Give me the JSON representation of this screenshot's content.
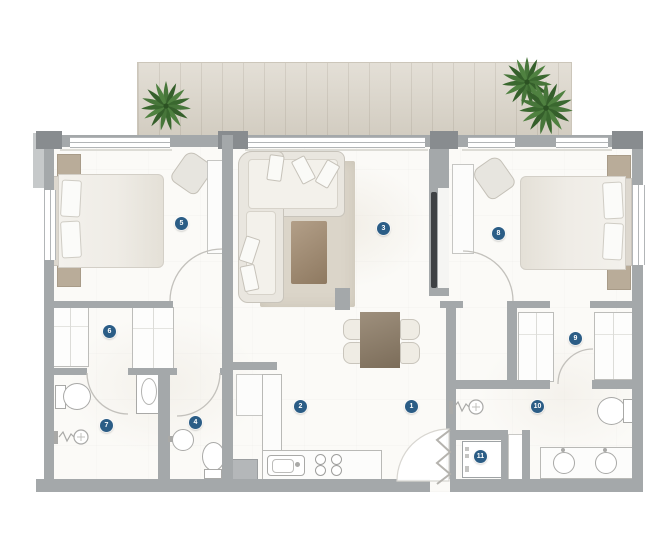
{
  "title": "apartment-floor-plan",
  "markers": [
    {
      "number": "1"
    },
    {
      "number": "2"
    },
    {
      "number": "3"
    },
    {
      "number": "4"
    },
    {
      "number": "5"
    },
    {
      "number": "6"
    },
    {
      "number": "7"
    },
    {
      "number": "8"
    },
    {
      "number": "9"
    },
    {
      "number": "10"
    },
    {
      "number": "11"
    }
  ],
  "icons": {
    "marker": "numbered-circle-badge",
    "plant": "potted-palm-top-view",
    "shower": "handheld-shower-symbol"
  },
  "colors": {
    "marker_blue": "#2b5d86",
    "wall_gray": "#a4a8aa",
    "wall_dark": "#888c8f",
    "deck_wood": "#d9d3c7",
    "rug_beige": "#dbd5c9",
    "table_brown": "#8d7c66",
    "furniture_beige": "#b9ac99",
    "plant_green": "#47763a",
    "floor_white": "#fbfaf7"
  }
}
